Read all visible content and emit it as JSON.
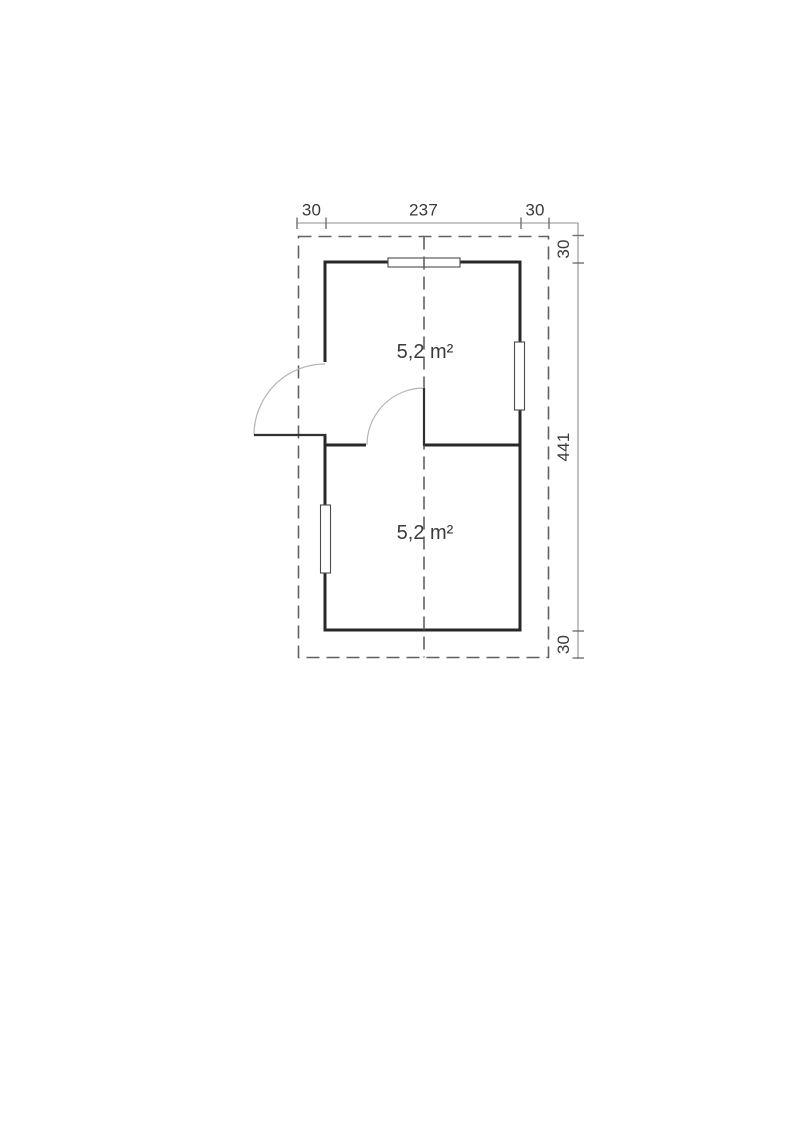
{
  "plan": {
    "type": "floor-plan",
    "rooms": [
      {
        "label": "5,2 m²"
      },
      {
        "label": "5,2 m²"
      }
    ],
    "dimensions": {
      "top": [
        {
          "label": "30"
        },
        {
          "label": "237"
        },
        {
          "label": "30"
        }
      ],
      "right": [
        {
          "label": "30"
        },
        {
          "label": "441"
        },
        {
          "label": "30"
        }
      ]
    },
    "colors": {
      "wall": "#282828",
      "dashed_line": "#616161",
      "dimension_line": "#8f8f8f",
      "tick": "#707070",
      "text": "#3a3a3a",
      "door_arc": "#b4b4b4",
      "door_leaf": "#303030",
      "window_border": "#4a4a4a",
      "window_fill": "#ffffff",
      "background": "#ffffff"
    }
  }
}
